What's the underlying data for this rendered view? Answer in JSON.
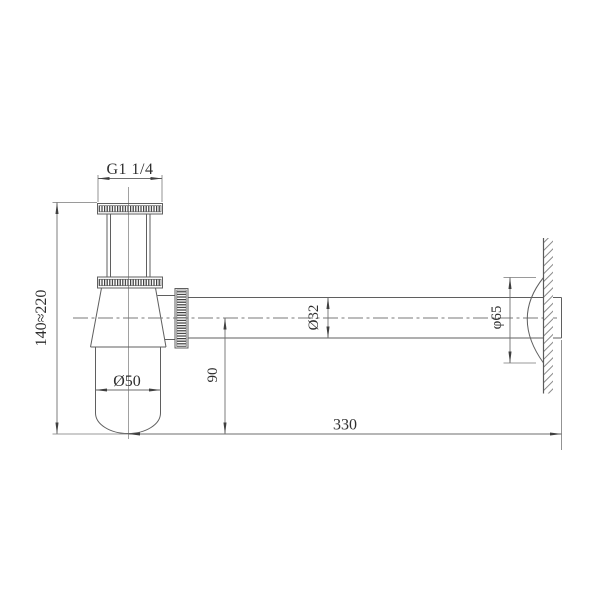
{
  "drawing": {
    "kind": "technical-drawing-bottle-trap",
    "background": "#ffffff",
    "object_line_color": "#5f5f5f",
    "dimension_line_color": "#6e6e6e",
    "text_color": "#2e2e2e",
    "knurl_color": "#3c3c3c",
    "hatch_color": "#8a8a8a",
    "dimensions": {
      "thread_size": "G1 1/4",
      "height_range": "140≈220",
      "body_diameter": "Ø50",
      "outlet_drop": "90",
      "pipe_diameter": "Ø32",
      "flange_diameter": "φ65",
      "pipe_length": "330"
    }
  }
}
